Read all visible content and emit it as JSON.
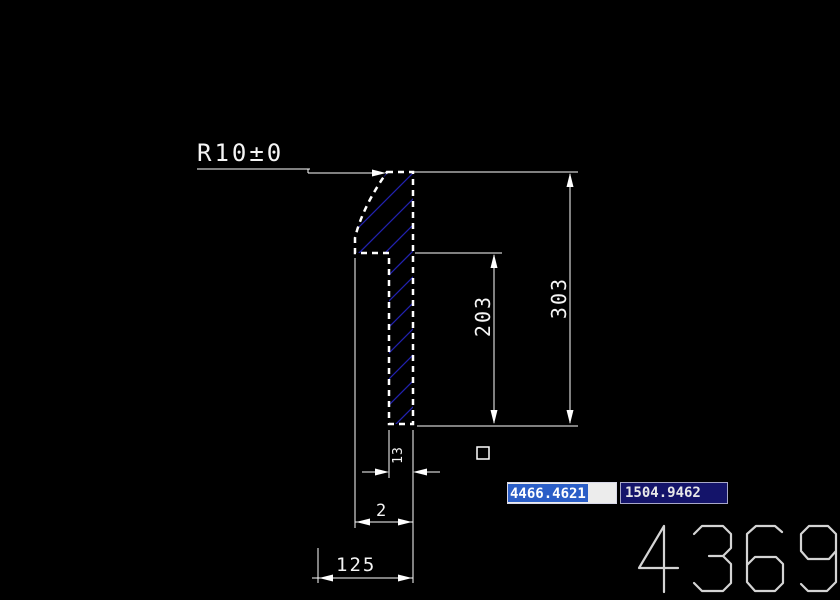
{
  "app": {
    "background": "#000000",
    "line_color": "#ffffff",
    "hatch_color": "#2626c2"
  },
  "drawing": {
    "radius_label": "R10±0",
    "dimensions": {
      "outer_height": "303",
      "inner_height": "203",
      "stem_width": "13",
      "flange_width": "2",
      "base_width": "125"
    }
  },
  "dynamic_input": {
    "x_field": {
      "value": "4466.4621",
      "selected": true,
      "selection_color": "#2b5ec7",
      "bg": "#ececec",
      "text_color": "#ffffff"
    },
    "y_field": {
      "value": "1504.9462",
      "bg": "#14146a",
      "border": "#a8a8c8",
      "text_color": "#e8e8e8"
    }
  },
  "watermark": {
    "text": "4369",
    "color": "#d4d4d4"
  }
}
